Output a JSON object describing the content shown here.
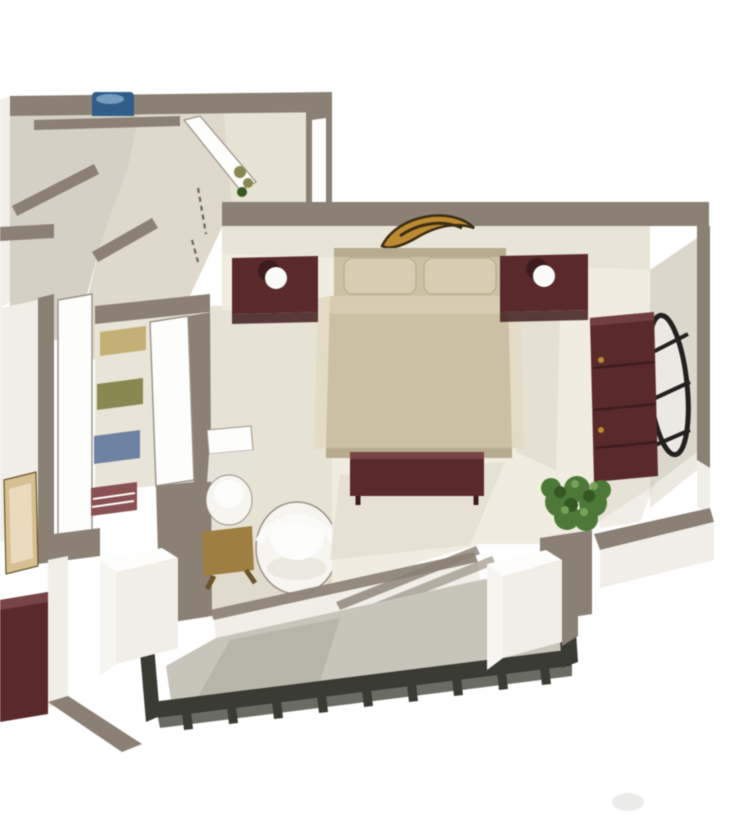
{
  "meta": {
    "title": "3D isometric apartment floor plan rendering",
    "view": "cutaway axonometric, white background, no text"
  },
  "scene": {
    "rooms": [
      {
        "name": "hallway",
        "items": [
          "washing-machine",
          "open-door",
          "wall-door-panel",
          "door-swing-dashed-line",
          "small-plant"
        ]
      },
      {
        "name": "side-room",
        "items": [
          "wall-picture",
          "maroon-furniture"
        ]
      },
      {
        "name": "closet",
        "items": [
          "shelf-clothes-tan",
          "shelf-clothes-olive",
          "shelf-clothes-blue",
          "shelf-clothes-maroon",
          "closet-door"
        ]
      },
      {
        "name": "bathroom",
        "items": [
          "toilet",
          "wooden-stool",
          "white-chair"
        ]
      },
      {
        "name": "bedroom",
        "items": [
          "double-bed",
          "pillows",
          "headboard-art",
          "nightstand-left",
          "nightstand-right",
          "table-lamp-left",
          "table-lamp-right",
          "foot-bench",
          "dresser",
          "oval-mirror",
          "potted-plant",
          "sliding-door-tracks"
        ]
      },
      {
        "name": "balcony",
        "items": [
          "planter-left",
          "planter-right",
          "railing",
          "railing-posts"
        ]
      }
    ]
  },
  "colors": {
    "bg": "#ffffff",
    "wall_top": "#8a8072",
    "wall_top_dark": "#6e665b",
    "wall_face": "#f0eee6",
    "back_wall": "#e8e4d6",
    "wall_face_shaded": "#dbd7c9",
    "floor_cream": "#f1ecdf",
    "floor_beige": "#ded9c9",
    "floor_gray": "#d4d0c3",
    "floor_bath": "#e6e2d3",
    "floor_balcony": "#c7c5b9",
    "balcony_shadow": "#b3b1a5",
    "railing": "#3a3b33",
    "railing_light": "#5a5b52",
    "shadow": "#d9d4c4",
    "maroon": "#5c2a2b",
    "maroon_dark": "#3f1c1d",
    "maroon_light": "#7a4446",
    "bed": "#cbbfa3",
    "bed_light": "#e3dbc5",
    "bed_edge": "#b7ab8e",
    "pillow": "#d8cdb2",
    "art_gold": "#bf8a2e",
    "art_dark": "#3c2c14",
    "lamp": "#fbfbf9",
    "mirror_frame": "#23211e",
    "mirror_glass": "#ebe9e3",
    "plant": "#4c7a36",
    "plant_dark": "#35571f",
    "plant_light": "#76a253",
    "wood": "#a07e3e",
    "wood_dark": "#6b5426",
    "washer_blue": "#2e5e8b",
    "washer_light": "#86add0",
    "white": "#fdfdfc",
    "outline": "#9a9184",
    "frame_tan": "#d7bf8f",
    "frame_tan_light": "#eadcbd",
    "clothes_tan": "#c4b071",
    "clothes_olive": "#8a8850",
    "clothes_blue": "#6d83a3",
    "clothes_maroon": "#8c5052",
    "toilet": "#f6f5ef",
    "toilet_shade": "#e5e2d8",
    "smudge": "#d8d8d4"
  }
}
